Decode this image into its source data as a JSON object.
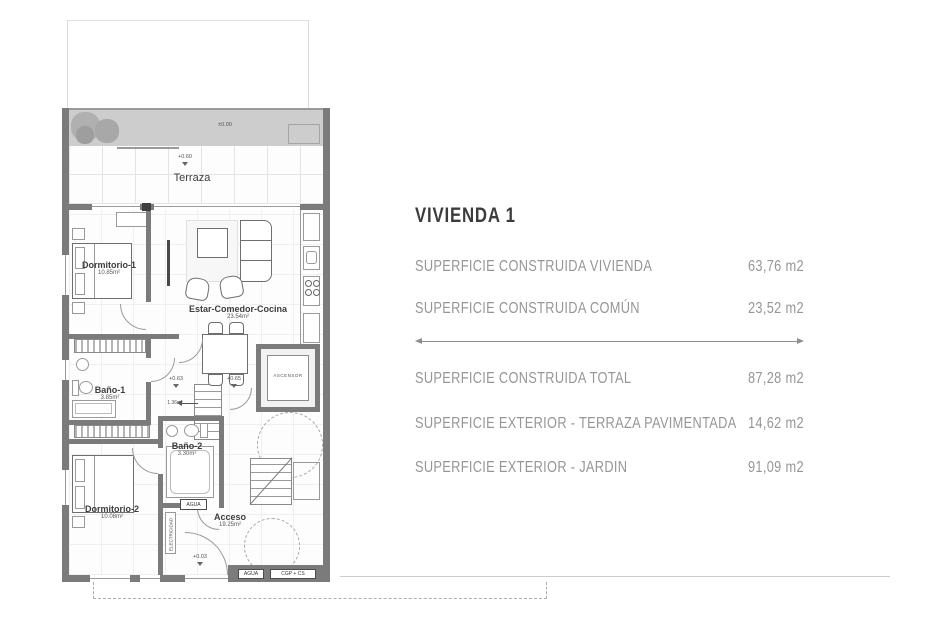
{
  "summary": {
    "title": "VIVIENDA 1",
    "rows": [
      {
        "label": "SUPERFICIE CONSTRUIDA VIVIENDA",
        "value": "63,76 m2"
      },
      {
        "label": "SUPERFICIE CONSTRUIDA COMÚN",
        "value": "23,52 m2"
      }
    ],
    "totals": [
      {
        "label": "SUPERFICIE CONSTRUIDA TOTAL",
        "value": "87,28 m2"
      },
      {
        "label": "SUPERFICIE EXTERIOR - TERRAZA PAVIMENTADA",
        "value": "14,62 m2"
      },
      {
        "label": "SUPERFICIE EXTERIOR - JARDIN",
        "value": "91,09 m2"
      }
    ]
  },
  "plan": {
    "rooms": {
      "terraza": {
        "name": "Terraza"
      },
      "dormitorio1": {
        "name": "Dormitorio-1",
        "area": "10.85m²"
      },
      "estar": {
        "name": "Estar-Comedor-Cocina",
        "area": "23.54m²"
      },
      "bano1": {
        "name": "Baño-1",
        "area": "3.85m²"
      },
      "bano2": {
        "name": "Baño-2",
        "area": "3.30m²"
      },
      "dormitorio2": {
        "name": "Dormitorio-2",
        "area": "10.08m²"
      },
      "acceso": {
        "name": "Acceso",
        "area": "19.25m²"
      },
      "hall": {
        "area": "1.36m²"
      },
      "ascensor": {
        "name": "ASCENSOR"
      }
    },
    "levels": {
      "ground": "±0.00",
      "terrace": "+0.60",
      "stair_left": "+0.63",
      "stair_right": "+0.65",
      "entrance": "+0.03"
    },
    "utilities": {
      "agua": "AGUA",
      "cgp": "CGP + CS",
      "electricidad": "ELECTRICIDAD"
    }
  },
  "colors": {
    "wall": "#7b7b7b",
    "text_gray": "#969696",
    "title": "#3c3c3c"
  }
}
